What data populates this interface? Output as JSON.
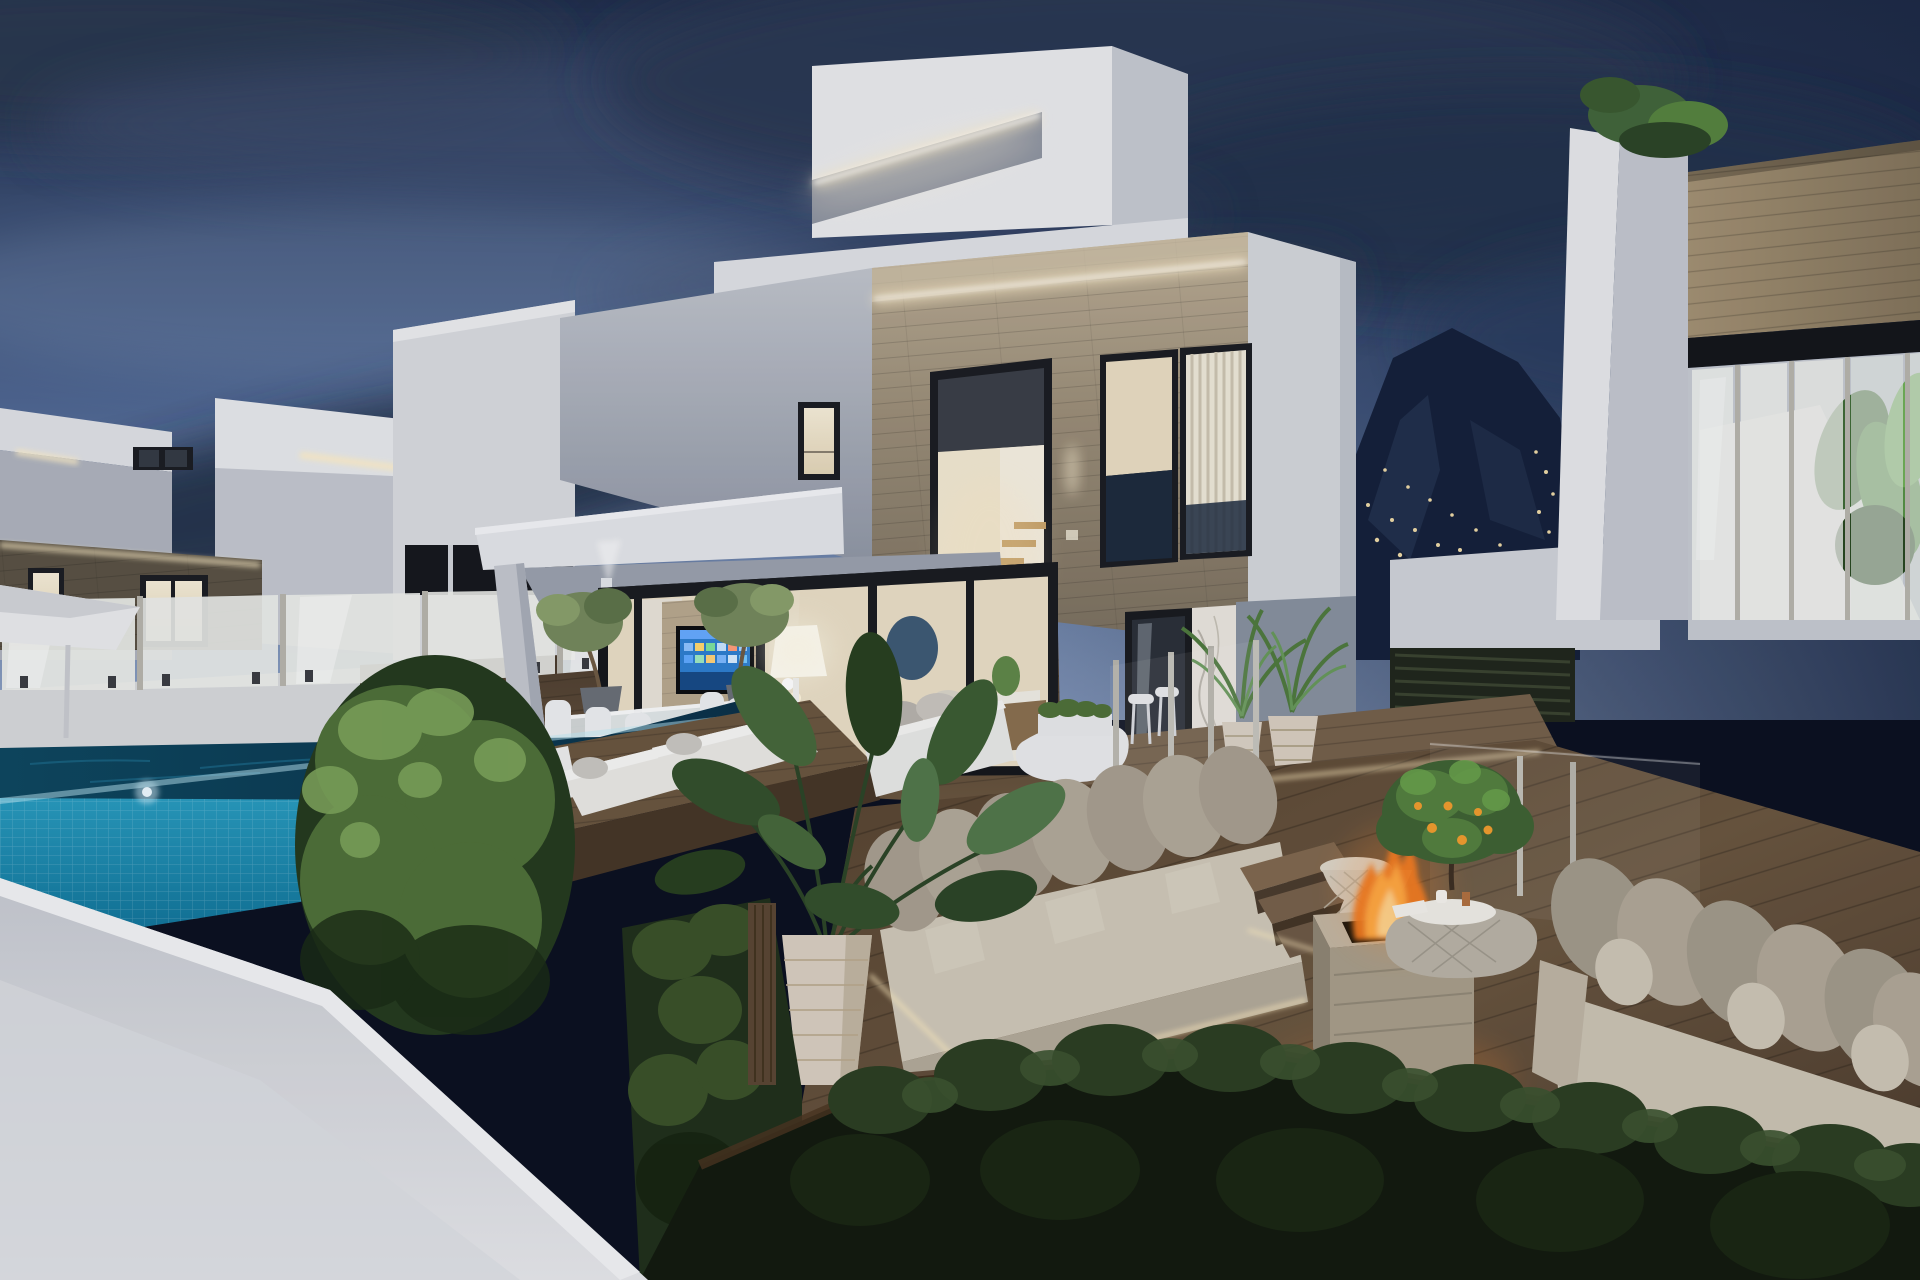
{
  "meta": {
    "kind": "3d-architectural-rendering",
    "time_of_day": "dusk",
    "width_px": 1920,
    "height_px": 1280
  },
  "scene": {
    "description": "Twilight exterior rendering of a modern two-storey white villa with stone-clad facade and cove LED lighting, flanked by similar villas. Foreground: turquoise infinity pool with glass balustrade and patio umbrella, wooden deck with white daybeds and dining set, clipped hedge ball, sunken lounge with beige sofas, burning travertine fire pit, wicker tables, potted citrus and palm plants, dark planting bed along the bottom, mountainside with village lights behind.",
    "objects": [
      "dusk-sky",
      "clouds",
      "mountain-silhouette",
      "village-lights",
      "far-left-villa",
      "left-villa",
      "patio-umbrella",
      "glass-balustrade",
      "main-villa",
      "roof-led-cove",
      "stone-facade",
      "stair-window",
      "blinds-window",
      "terrace-canopy",
      "wall-light",
      "sliding-glass-doors",
      "tv-screen",
      "floor-lamp",
      "dining-set",
      "olive-trees",
      "wicker-lanterns",
      "infinity-pool",
      "pool-underwater-lights",
      "perimeter-wall",
      "boxwood-hedge",
      "daybed-platform",
      "daybeds",
      "white-outdoor-sofa",
      "upper-terrace",
      "bar-counter",
      "bar-stools",
      "palm-pots",
      "glass-wind-screens",
      "lounge-floor",
      "lounge-sofa-left",
      "lounge-sofa-right",
      "wood-steps",
      "fire-pit",
      "fire-flames",
      "wicker-side-table",
      "wicker-coffee-table",
      "citrus-tree",
      "tropical-plant",
      "ribbed-planter",
      "led-floor-strips",
      "planting-bed",
      "right-villa",
      "wood-clad-band",
      "balustrade-plants",
      "pergola-slats"
    ]
  },
  "palette": {
    "sky_top": "#22304c",
    "sky_mid": "#4d6590",
    "sky_low": "#8ca1c4",
    "cloud_dark": "#2a374f",
    "cloud_mid": "#3d4e6e",
    "cloud_light": "#93a7c7",
    "mountain": "#15203a",
    "mountain_facet": "#2c3e5c",
    "village_light": "#ecd8a6",
    "wall_white": "#e9eaed",
    "wall_light": "#d6d8dd",
    "wall_shade": "#b4b9c3",
    "wall_dark": "#8f96a4",
    "canopy_underside": "#9aa1ad",
    "led_warm": "#ffefc8",
    "led_core": "#ffffff",
    "stone_light": "#bcae96",
    "stone_mid": "#9a8d77",
    "stone_dark": "#7a6f5e",
    "stone_left_villa": "#5a5244",
    "wood_band": "#a39173",
    "window_frame": "#1b1d22",
    "glass_dark": "#262c36",
    "interior_warm": "#f2e8d1",
    "interior_cream": "#e9dec6",
    "blind_stripe": "#eee8d9",
    "tv_blue": "#2e7fd0",
    "tv_blue_dark": "#174a86",
    "lamp_glow": "#fffdf4",
    "pool_face_light": "#35b3d6",
    "pool_face_dark": "#0e6f94",
    "pool_surface": "#0d475f",
    "pool_surface_deep": "#0a3148",
    "pool_ripple": "#1a6584",
    "deck_wood": "#6a563f",
    "deck_wood_dark": "#4a3b2d",
    "deck_wood_light": "#80684e",
    "hedge_light": "#7ca25a",
    "hedge_mid": "#4f7038",
    "hedge_dark": "#243a1e",
    "plant_dark": "#2c4526",
    "plant_mid": "#46683a",
    "sofa_cushion": "#a89f90",
    "sofa_cushion_light": "#c3bbab",
    "sofa_seat": "#cfc8b8",
    "sofa_shadow": "#8a8274",
    "fire_core": "#ffe29e",
    "fire_mid": "#ffae45",
    "fire_deep": "#f07820",
    "firepit_stone": "#b6ab97",
    "firepit_inset": "#131008",
    "pot_beige": "#d8cec0",
    "pot_shadow": "#b3a78e",
    "wicker": "#d3cdc0",
    "glass_panel": "#eceeea",
    "steel_post": "#b7b5ac",
    "marble": "#e9e5de",
    "slate_wall": "#87919f",
    "soil": "#4b3520",
    "bed_dark": "#121a0e"
  }
}
